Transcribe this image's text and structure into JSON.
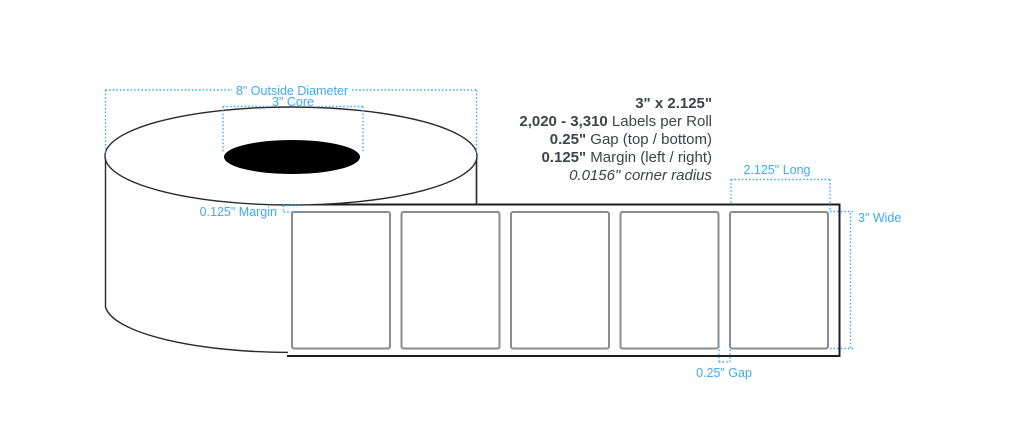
{
  "specs": {
    "size": "3\" x 2.125\"",
    "labels_per_roll_value": "2,020 - 3,310",
    "labels_per_roll_label": " Labels per Roll",
    "gap_value": "0.25\"",
    "gap_label": " Gap (top / bottom)",
    "margin_value": "0.125\"",
    "margin_label": " Margin (left / right)",
    "corner_radius": "0.0156\" corner radius"
  },
  "annotations": {
    "outside_diameter": "8\" Outside Diameter",
    "core": "3\" Core",
    "margin": "0.125\" Margin",
    "length": "2.125\" Long",
    "width": "3\" Wide",
    "gap": "0.25\" Gap"
  },
  "colors": {
    "annotation_blue": "#3fa9f5",
    "spec_text": "#3e4249",
    "roll_outline": "#2a2a2a",
    "strip_outline": "#1e1e1e",
    "label_border": "#8c8c8c",
    "core_fill": "#000000"
  },
  "diagram": {
    "labels_shown": 5
  }
}
